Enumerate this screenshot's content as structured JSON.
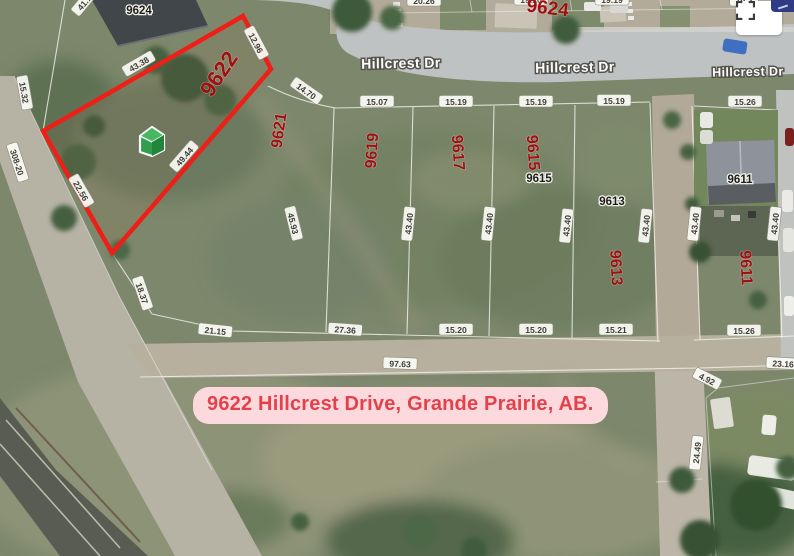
{
  "banner": {
    "text": "9622 Hillcrest Drive, Grande Prairie, AB.",
    "bg": "#fcd9dd",
    "color": "#e5414b"
  },
  "highlight": {
    "lot": "9622",
    "points": "243,16 271,69 112,253 43,131",
    "color": "#ee1f17"
  },
  "icons": {
    "fullscreen": "corner-brackets-fullscreen",
    "partial_control": "navy-collapsed-control",
    "house_marker": "green-3d-house-marker"
  },
  "streets": [
    {
      "t": "Hillcrest Dr",
      "x": 401,
      "y": 68,
      "r": -1,
      "s": 14
    },
    {
      "t": "Hillcrest Dr",
      "x": 575,
      "y": 72,
      "r": -1,
      "s": 14
    },
    {
      "t": "Hillcrest Dr",
      "x": 748,
      "y": 76,
      "r": -1,
      "s": 12.5
    }
  ],
  "lot_numbers_red": [
    {
      "t": "9622",
      "x": 225,
      "y": 78,
      "r": -56,
      "s": 22
    },
    {
      "t": "9621",
      "x": 284,
      "y": 131,
      "r": -82,
      "s": 16
    },
    {
      "t": "9619",
      "x": 377,
      "y": 151,
      "r": -86,
      "s": 16
    },
    {
      "t": "9617",
      "x": 453,
      "y": 153,
      "r": 86,
      "s": 16
    },
    {
      "t": "9615",
      "x": 528,
      "y": 153,
      "r": 86,
      "s": 16
    },
    {
      "t": "9613",
      "x": 611,
      "y": 268,
      "r": 87,
      "s": 16
    },
    {
      "t": "9611",
      "x": 741,
      "y": 268,
      "r": 87,
      "s": 16
    },
    {
      "t": "9624",
      "x": 547,
      "y": 14,
      "r": 7,
      "s": 19
    }
  ],
  "house_numbers": [
    {
      "t": "9624",
      "x": 139,
      "y": 14
    },
    {
      "t": "9615",
      "x": 539,
      "y": 182
    },
    {
      "t": "9613",
      "x": 612,
      "y": 205
    },
    {
      "t": "9611",
      "x": 740,
      "y": 183
    }
  ],
  "dimensions": [
    {
      "t": "41.1",
      "x": 86,
      "y": 4,
      "r": -50
    },
    {
      "t": "43.38",
      "x": 140,
      "y": 66,
      "r": -30
    },
    {
      "t": "12.96",
      "x": 254,
      "y": 44,
      "r": 62
    },
    {
      "t": "49.44",
      "x": 186,
      "y": 158,
      "r": -49
    },
    {
      "t": "22.56",
      "x": 79,
      "y": 192,
      "r": 60
    },
    {
      "t": "15.32",
      "x": 22,
      "y": 93,
      "r": 80
    },
    {
      "t": "308-20",
      "x": 15,
      "y": 163,
      "r": 72
    },
    {
      "t": "18.37",
      "x": 140,
      "y": 294,
      "r": 71
    },
    {
      "t": "14.70",
      "x": 305,
      "y": 93,
      "r": 35
    },
    {
      "t": "15.07",
      "x": 377,
      "y": 104,
      "r": 0
    },
    {
      "t": "15.19",
      "x": 456,
      "y": 104,
      "r": 0
    },
    {
      "t": "15.19",
      "x": 536,
      "y": 104,
      "r": 0
    },
    {
      "t": "15.19",
      "x": 614,
      "y": 103,
      "r": 0
    },
    {
      "t": "15.26",
      "x": 745,
      "y": 104,
      "r": 0
    },
    {
      "t": "20.26",
      "x": 424,
      "y": 3,
      "r": 0
    },
    {
      "t": "19.20",
      "x": 531,
      "y": 2,
      "r": 0
    },
    {
      "t": "19.19",
      "x": 612,
      "y": 2,
      "r": 0
    },
    {
      "t": "19.2",
      "x": 744,
      "y": 3,
      "r": 0
    },
    {
      "t": "45.93",
      "x": 291,
      "y": 224,
      "r": 76
    },
    {
      "t": "43.40",
      "x": 411,
      "y": 224,
      "r": -84
    },
    {
      "t": "43.40",
      "x": 491,
      "y": 224,
      "r": -84
    },
    {
      "t": "43.40",
      "x": 569,
      "y": 226,
      "r": -84
    },
    {
      "t": "43.40",
      "x": 648,
      "y": 226,
      "r": -84
    },
    {
      "t": "43.40",
      "x": 697,
      "y": 224,
      "r": -84
    },
    {
      "t": "43.40",
      "x": 777,
      "y": 224,
      "r": -84
    },
    {
      "t": "21.15",
      "x": 215,
      "y": 333,
      "r": 6
    },
    {
      "t": "27.36",
      "x": 345,
      "y": 332,
      "r": 4
    },
    {
      "t": "97.63",
      "x": 400,
      "y": 366,
      "r": 2
    },
    {
      "t": "15.20",
      "x": 456,
      "y": 332,
      "r": 0
    },
    {
      "t": "15.20",
      "x": 536,
      "y": 332,
      "r": 0
    },
    {
      "t": "15.21",
      "x": 616,
      "y": 332,
      "r": 0
    },
    {
      "t": "15.26",
      "x": 744,
      "y": 333,
      "r": 0
    },
    {
      "t": "23.16",
      "x": 783,
      "y": 366,
      "r": 3
    },
    {
      "t": "4.92",
      "x": 706,
      "y": 381,
      "r": 27
    },
    {
      "t": "24.49",
      "x": 699,
      "y": 453,
      "r": -84
    }
  ]
}
